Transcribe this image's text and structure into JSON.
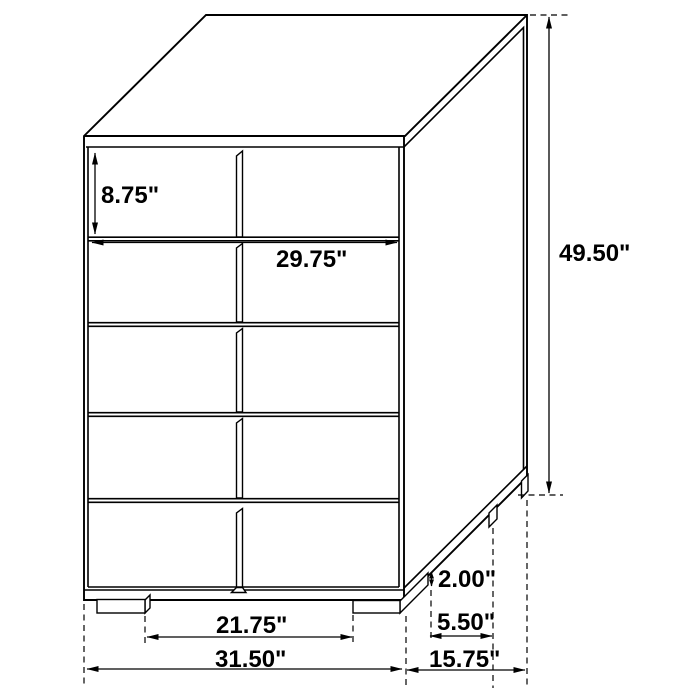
{
  "diagram": {
    "kind": "furniture-dimension-drawing",
    "subject": "five-drawer-chest",
    "units": "inches",
    "drawer_count": 5,
    "colors": {
      "line": "#000000",
      "background": "#ffffff",
      "text": "#000000"
    },
    "dimensions": {
      "drawer_height": "8.75\"",
      "interior_width": "29.75\"",
      "overall_height": "49.50\"",
      "leg_height": "2.00\"",
      "leg_depth": "5.50\"",
      "leg_spacing": "21.75\"",
      "overall_width": "31.50\"",
      "overall_depth": "15.75\""
    }
  }
}
